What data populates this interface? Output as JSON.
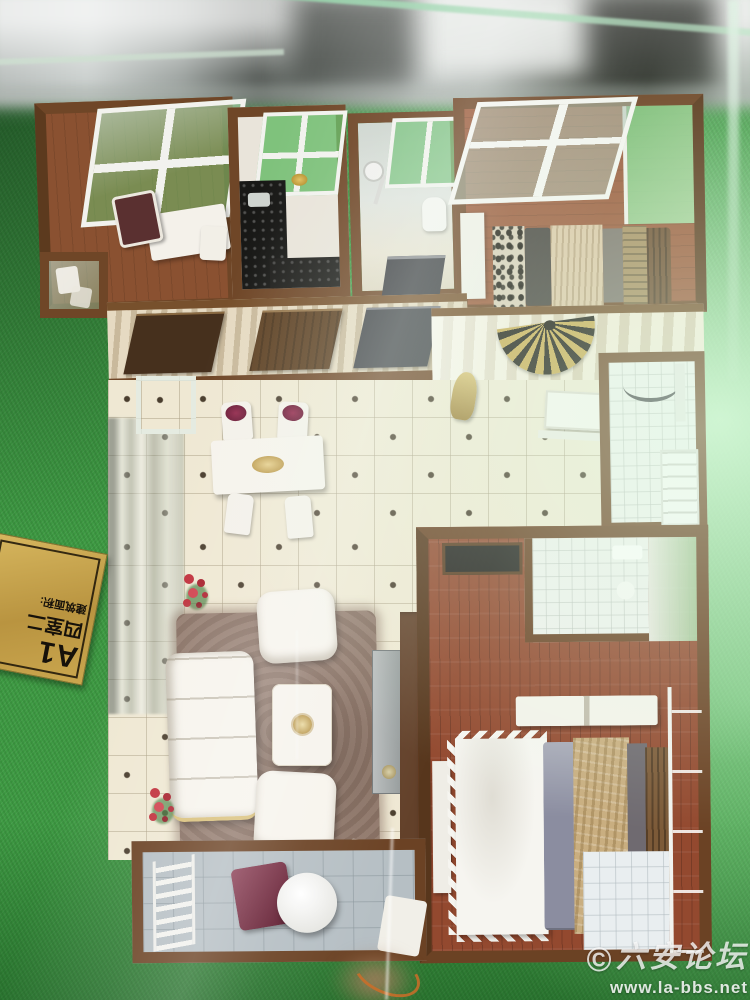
{
  "photo": {
    "plaque": {
      "line1": "A1",
      "line2": "四室二",
      "line3": "建筑面积:"
    },
    "watermark": {
      "copyright": "©",
      "site": "六安论坛",
      "url": "www.la-bbs.net"
    },
    "palette": {
      "grass_green": "#3e9a43",
      "grass_dark": "#2c7a33",
      "grass_bright": "#c4f0c6",
      "wall_brown": "#6f4627",
      "wood_floor_study": "#8a5131",
      "wood_floor_bedroom": "#93492f",
      "tile_cream": "#efe8d3",
      "plaque_gold": "#c9a84c",
      "rug_taupe": "#8d7466",
      "sofa_white": "#f7f4ed",
      "chair_maroon": "#79203a",
      "quilt_gold": "#c9ae80",
      "pillow_grey": "#8b8da0",
      "kitchen_counter_black": "#181816",
      "balcony_tile_grey": "#b6bfc4"
    }
  }
}
